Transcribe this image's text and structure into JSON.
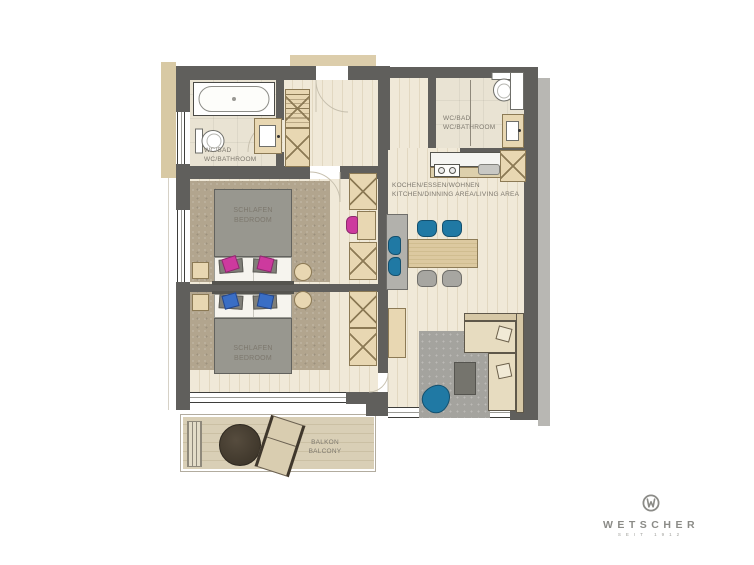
{
  "plan_type": "apartment-floor-plan",
  "rooms": {
    "bathroom_top_left": {
      "line1": "WC/BAD",
      "line2": "WC/BATHROOM"
    },
    "bathroom_top_right": {
      "line1": "WC/BAD",
      "line2": "WC/BATHROOM"
    },
    "kitchen_living": {
      "line1": "KOCHEN/ESSEN/WOHNEN",
      "line2": "KITCHEN/DINNING AREA/LIVING AREA"
    },
    "bedroom_1": {
      "line1": "SCHLAFEN",
      "line2": "BEDROOM"
    },
    "bedroom_2": {
      "line1": "SCHLAFEN",
      "line2": "BEDROOM"
    },
    "balcony": {
      "line1": "BALKON",
      "line2": "BALCONY"
    }
  },
  "logo": {
    "brand": "WETSCHER",
    "tagline": "SEIT 1912"
  },
  "colors": {
    "wall": "#605f5c",
    "wood_floor": "#f0e9d8",
    "bathroom_floor": "#e9e3d3",
    "carpet": "#b2a58e",
    "balcony_floor": "#d9cfb6",
    "furniture_beige": "#e8d7b2",
    "accent_magenta": "#cd3a9e",
    "accent_blue": "#2079a4",
    "pillow_blue": "#3a6ec5",
    "label_text": "#7d786e",
    "logo_gray": "#8b8b87"
  }
}
